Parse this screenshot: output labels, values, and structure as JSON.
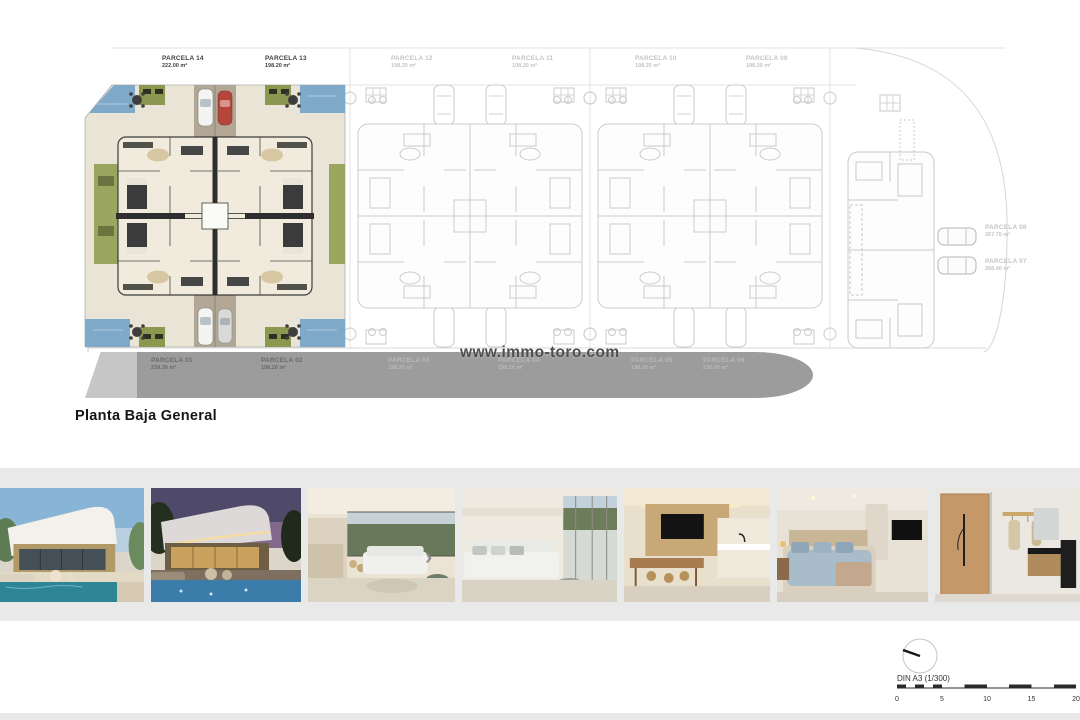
{
  "plan": {
    "title": "Planta Baja General",
    "watermark": "www.immo-toro.com",
    "parcels_top": [
      {
        "label": "PARCELA 14",
        "area": "222.00 m²"
      },
      {
        "label": "PARCELA 13",
        "area": "198.20 m²"
      },
      {
        "label": "PARCELA 12",
        "area": "198.20 m²"
      },
      {
        "label": "PARCELA 11",
        "area": "198.20 m²"
      },
      {
        "label": "PARCELA 10",
        "area": "198.20 m²"
      },
      {
        "label": "PARCELA 09",
        "area": "198.20 m²"
      }
    ],
    "parcels_right": [
      {
        "label": "PARCELA 08",
        "area": "267.70 m²"
      },
      {
        "label": "PARCELA 07",
        "area": "268.40 m²"
      }
    ],
    "parcels_bottom": [
      {
        "label": "PARCELA 01",
        "area": "239.30 m²"
      },
      {
        "label": "PARCELA 02",
        "area": "198.20 m²"
      },
      {
        "label": "PARCELA 03",
        "area": "198.20 m²"
      },
      {
        "label": "PARCELA 04",
        "area": "198.20 m²"
      },
      {
        "label": "PARCELA 05",
        "area": "198.20 m²"
      },
      {
        "label": "PARCELA 06",
        "area": "230.00 m²"
      }
    ]
  },
  "scale_bar": {
    "label": "DIN A3 (1/300)",
    "ticks": [
      "0",
      "5",
      "10",
      "15",
      "20"
    ]
  },
  "gallery": {
    "photos": [
      {
        "name": "villa-exterior-day"
      },
      {
        "name": "villa-exterior-dusk"
      },
      {
        "name": "living-room-kitchen-view"
      },
      {
        "name": "living-room-terrace"
      },
      {
        "name": "kitchen-dining"
      },
      {
        "name": "bedroom"
      },
      {
        "name": "bathroom"
      }
    ],
    "next_icon": "›"
  },
  "colors": {
    "pool": "#7fa9c9",
    "grass": "#9aa55e",
    "band": "#9c9c9c",
    "floor_cream": "#e9e4d6",
    "accent_red": "#b6453c"
  }
}
